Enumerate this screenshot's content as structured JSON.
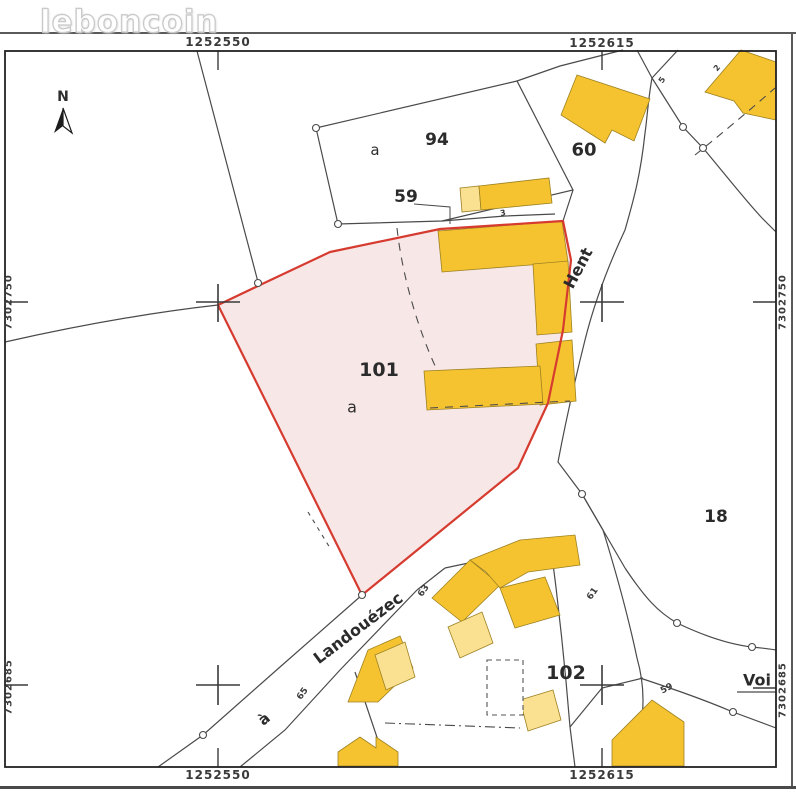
{
  "logo": {
    "brand": "leboncoin"
  },
  "frame": {
    "coord_top_left": "1252550",
    "coord_top_right": "1252615",
    "coord_bottom_left": "1252550",
    "coord_bottom_right": "1252615",
    "coord_left_upper": "7302750",
    "coord_left_lower": "7302685",
    "coord_right_upper": "7302750",
    "coord_right_lower": "7302685"
  },
  "compass": {
    "north": "N"
  },
  "parcels": {
    "p94": {
      "number": "94",
      "letter": "a"
    },
    "p59": {
      "number": "59"
    },
    "p60": {
      "number": "60"
    },
    "p101": {
      "number": "101",
      "letter": "a"
    },
    "p18": {
      "number": "18"
    },
    "p102": {
      "number": "102"
    }
  },
  "streets": {
    "hent": "Hent",
    "landouezec": "Landouézec",
    "a_prefix": "à",
    "voie": "Voi"
  },
  "house_numbers": {
    "n3": "3",
    "n5": "5",
    "n2": "2",
    "n63": "63",
    "n61": "61",
    "n65": "65",
    "n59": "59"
  },
  "colors": {
    "building": "#F6C330",
    "building_light": "#FAE091",
    "building_edge": "#9c8121",
    "highlight_fill": "#F8E7E7",
    "highlight_stroke": "#D63B2F",
    "line": "#4a4a4a",
    "frame": "#222222"
  }
}
